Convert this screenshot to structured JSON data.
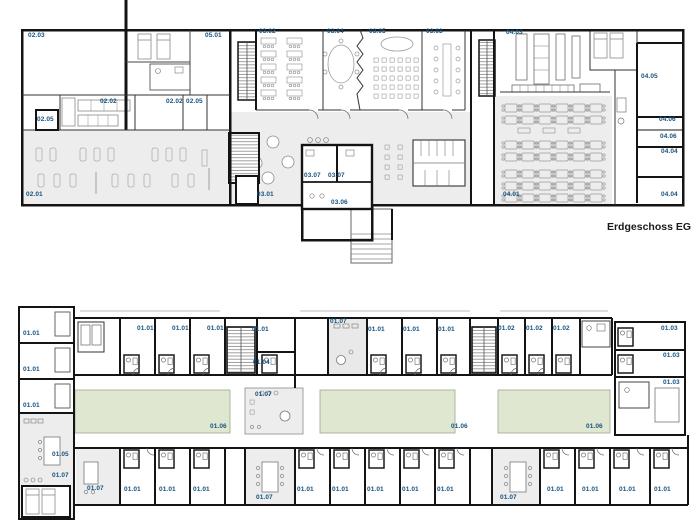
{
  "caption": {
    "text": "Erdgeschoss EG"
  },
  "colors": {
    "label_blue": "#17527E",
    "wall_black": "#141414",
    "floor_gray": "#EDEDED",
    "courtyard_green": "#DFE7D0",
    "furniture_gray": "#999999"
  },
  "floors": [
    {
      "id": "ground-floor",
      "labels": [
        {
          "text": "02.03",
          "x": 28,
          "y": 33
        },
        {
          "text": "05.01",
          "x": 205,
          "y": 33
        },
        {
          "text": "02.02",
          "x": 100,
          "y": 99
        },
        {
          "text": "02.02",
          "x": 166,
          "y": 99
        },
        {
          "text": "02.05",
          "x": 186,
          "y": 99
        },
        {
          "text": "02.05",
          "x": 37,
          "y": 117
        },
        {
          "text": "02.01",
          "x": 26,
          "y": 192
        },
        {
          "text": "03.02",
          "x": 259,
          "y": 29
        },
        {
          "text": "03.04",
          "x": 327,
          "y": 29
        },
        {
          "text": "03.05",
          "x": 369,
          "y": 29
        },
        {
          "text": "03.03",
          "x": 426,
          "y": 29
        },
        {
          "text": "04.03",
          "x": 506,
          "y": 30
        },
        {
          "text": "04.05",
          "x": 641,
          "y": 74
        },
        {
          "text": "04.06",
          "x": 659,
          "y": 117
        },
        {
          "text": "04.06",
          "x": 660,
          "y": 134
        },
        {
          "text": "04.04",
          "x": 661,
          "y": 149
        },
        {
          "text": "04.04",
          "x": 661,
          "y": 192
        },
        {
          "text": "03.01",
          "x": 257,
          "y": 192
        },
        {
          "text": "03.07",
          "x": 304,
          "y": 173
        },
        {
          "text": "03.07",
          "x": 328,
          "y": 173
        },
        {
          "text": "03.06",
          "x": 331,
          "y": 200
        },
        {
          "text": "04.01",
          "x": 503,
          "y": 192
        }
      ]
    },
    {
      "id": "upper-floor",
      "labels": [
        {
          "text": "01.01",
          "x": 23,
          "y": 331
        },
        {
          "text": "01.01",
          "x": 23,
          "y": 367
        },
        {
          "text": "01.01",
          "x": 23,
          "y": 403
        },
        {
          "text": "01.05",
          "x": 52,
          "y": 452
        },
        {
          "text": "01.07",
          "x": 52,
          "y": 473
        },
        {
          "text": "01.01",
          "x": 137,
          "y": 326
        },
        {
          "text": "01.01",
          "x": 172,
          "y": 326
        },
        {
          "text": "01.01",
          "x": 207,
          "y": 326
        },
        {
          "text": "01.01",
          "x": 252,
          "y": 327
        },
        {
          "text": "01.04",
          "x": 253,
          "y": 360
        },
        {
          "text": "01.07",
          "x": 330,
          "y": 319
        },
        {
          "text": "01.01",
          "x": 368,
          "y": 327
        },
        {
          "text": "01.01",
          "x": 403,
          "y": 327
        },
        {
          "text": "01.01",
          "x": 438,
          "y": 327
        },
        {
          "text": "01.02",
          "x": 498,
          "y": 326
        },
        {
          "text": "01.02",
          "x": 526,
          "y": 326
        },
        {
          "text": "01.02",
          "x": 553,
          "y": 326
        },
        {
          "text": "01.03",
          "x": 661,
          "y": 326
        },
        {
          "text": "01.03",
          "x": 663,
          "y": 353
        },
        {
          "text": "01.03",
          "x": 663,
          "y": 380
        },
        {
          "text": "01.06",
          "x": 210,
          "y": 424
        },
        {
          "text": "01.07",
          "x": 255,
          "y": 392
        },
        {
          "text": "01.06",
          "x": 451,
          "y": 424
        },
        {
          "text": "01.06",
          "x": 586,
          "y": 424
        },
        {
          "text": "01.07",
          "x": 87,
          "y": 486
        },
        {
          "text": "01.01",
          "x": 124,
          "y": 487
        },
        {
          "text": "01.01",
          "x": 159,
          "y": 487
        },
        {
          "text": "01.01",
          "x": 193,
          "y": 487
        },
        {
          "text": "01.07",
          "x": 256,
          "y": 495
        },
        {
          "text": "01.01",
          "x": 297,
          "y": 487
        },
        {
          "text": "01.01",
          "x": 332,
          "y": 487
        },
        {
          "text": "01.01",
          "x": 367,
          "y": 487
        },
        {
          "text": "01.01",
          "x": 402,
          "y": 487
        },
        {
          "text": "01.01",
          "x": 437,
          "y": 487
        },
        {
          "text": "01.07",
          "x": 500,
          "y": 495
        },
        {
          "text": "01.01",
          "x": 547,
          "y": 487
        },
        {
          "text": "01.01",
          "x": 582,
          "y": 487
        },
        {
          "text": "01.01",
          "x": 619,
          "y": 487
        },
        {
          "text": "01.01",
          "x": 654,
          "y": 487
        }
      ]
    }
  ]
}
